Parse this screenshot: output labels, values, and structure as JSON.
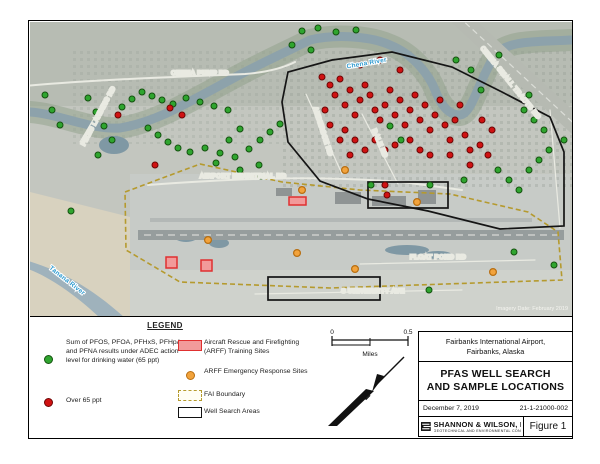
{
  "figure": {
    "legend": {
      "title": "LEGEND",
      "items": [
        {
          "symbol": "green-dot",
          "label": "Sum of PFOS, PFOA, PFHxS, PFHpA, and PFNA results under ADEC action level for drinking water (65 ppt)"
        },
        {
          "symbol": "red-dot",
          "label": "Over 65 ppt"
        },
        {
          "symbol": "arff-training-swatch",
          "label": "Aircraft Rescue and Firefighting (ARFF) Training Sites"
        },
        {
          "symbol": "orange-dot",
          "label": "ARFF Emergency Response Sites"
        },
        {
          "symbol": "fai-boundary-swatch",
          "label": "FAI Boundary"
        },
        {
          "symbol": "well-search-swatch",
          "label": "Well Search Areas"
        }
      ]
    },
    "scale_bar": {
      "left": "0",
      "right": "0.5",
      "units": "Miles"
    },
    "north_arrow": "N",
    "title_block": {
      "location_line1": "Fairbanks International Airport,",
      "location_line2": "Fairbanks, Alaska",
      "title_line1": "PFAS WELL SEARCH",
      "title_line2": "AND SAMPLE LOCATIONS",
      "date": "December 7, 2019",
      "project_number": "21-1-21000-002",
      "company": "SHANNON & WILSON, INC.",
      "company_tagline": "GEOTECHNICAL AND ENVIRONMENTAL CONSULTANTS",
      "figure_label": "Figure 1"
    },
    "map": {
      "credit": "Imagery Date: February 2019",
      "colors": {
        "under_green": "#2fa52f",
        "over_red": "#d01212",
        "arff_orange": "#f2a33c",
        "training_fill": "#f29a9a",
        "training_stroke": "#e03030",
        "fai_boundary": "#b59a2e",
        "water_label": "#2f9bd0"
      },
      "labels": [
        {
          "text": "CHENA PUMP RD",
          "x": 170,
          "y": 53,
          "rot": 0,
          "kind": "road"
        },
        {
          "text": "Chena River",
          "x": 337,
          "y": 43,
          "rot": -10,
          "kind": "water"
        },
        {
          "text": "CHENA SMALL TRACTS RD",
          "x": 479,
          "y": 62,
          "rot": 51,
          "kind": "road"
        },
        {
          "text": "PIKES LANDING RD",
          "x": 70,
          "y": 95,
          "rot": -62,
          "kind": "road"
        },
        {
          "text": "AIRPORT INDUSTRIAL RD",
          "x": 213,
          "y": 156,
          "rot": 0,
          "kind": "road"
        },
        {
          "text": "ANDERSON RD",
          "x": 291,
          "y": 110,
          "rot": 72,
          "kind": "road"
        },
        {
          "text": "DALE RD",
          "x": 348,
          "y": 122,
          "rot": 67,
          "kind": "road"
        },
        {
          "text": "FLOAT POND RD",
          "x": 408,
          "y": 237,
          "rot": 0,
          "kind": "road"
        },
        {
          "text": "S UNIVERSITY AVE",
          "x": 343,
          "y": 271,
          "rot": 0,
          "kind": "road"
        },
        {
          "text": "Tanana River",
          "x": 36,
          "y": 260,
          "rot": 38,
          "kind": "water"
        },
        {
          "text": "Imagery Date: February 2019",
          "x": 538,
          "y": 288,
          "rot": 0,
          "kind": "credit"
        }
      ],
      "markers": {
        "green": [
          [
            15,
            73
          ],
          [
            22,
            88
          ],
          [
            30,
            103
          ],
          [
            58,
            76
          ],
          [
            66,
            90
          ],
          [
            74,
            104
          ],
          [
            82,
            118
          ],
          [
            68,
            133
          ],
          [
            92,
            85
          ],
          [
            102,
            77
          ],
          [
            112,
            70
          ],
          [
            122,
            74
          ],
          [
            132,
            78
          ],
          [
            143,
            82
          ],
          [
            156,
            76
          ],
          [
            170,
            80
          ],
          [
            184,
            84
          ],
          [
            198,
            88
          ],
          [
            118,
            106
          ],
          [
            128,
            113
          ],
          [
            138,
            120
          ],
          [
            148,
            126
          ],
          [
            160,
            130
          ],
          [
            175,
            126
          ],
          [
            190,
            131
          ],
          [
            205,
            135
          ],
          [
            219,
            127
          ],
          [
            230,
            118
          ],
          [
            240,
            110
          ],
          [
            250,
            102
          ],
          [
            210,
            107
          ],
          [
            199,
            118
          ],
          [
            186,
            141
          ],
          [
            210,
            148
          ],
          [
            229,
            143
          ],
          [
            262,
            23
          ],
          [
            272,
            9
          ],
          [
            288,
            6
          ],
          [
            306,
            10
          ],
          [
            326,
            8
          ],
          [
            281,
            28
          ],
          [
            360,
            104
          ],
          [
            371,
            118
          ],
          [
            341,
            163
          ],
          [
            400,
            163
          ],
          [
            434,
            158
          ],
          [
            468,
            148
          ],
          [
            479,
            158
          ],
          [
            489,
            168
          ],
          [
            499,
            148
          ],
          [
            509,
            138
          ],
          [
            519,
            128
          ],
          [
            514,
            108
          ],
          [
            504,
            98
          ],
          [
            494,
            88
          ],
          [
            451,
            68
          ],
          [
            441,
            48
          ],
          [
            426,
            38
          ],
          [
            469,
            33
          ],
          [
            499,
            73
          ],
          [
            484,
            230
          ],
          [
            399,
            268
          ],
          [
            231,
            154
          ],
          [
            41,
            189
          ],
          [
            524,
            243
          ],
          [
            534,
            118
          ]
        ],
        "red": [
          [
            292,
            55
          ],
          [
            300,
            63
          ],
          [
            310,
            57
          ],
          [
            305,
            73
          ],
          [
            315,
            83
          ],
          [
            295,
            88
          ],
          [
            320,
            68
          ],
          [
            325,
            93
          ],
          [
            330,
            78
          ],
          [
            335,
            63
          ],
          [
            340,
            73
          ],
          [
            345,
            88
          ],
          [
            350,
            98
          ],
          [
            355,
            83
          ],
          [
            360,
            68
          ],
          [
            365,
            93
          ],
          [
            370,
            78
          ],
          [
            375,
            103
          ],
          [
            380,
            88
          ],
          [
            385,
            73
          ],
          [
            390,
            98
          ],
          [
            395,
            83
          ],
          [
            400,
            108
          ],
          [
            405,
            93
          ],
          [
            410,
            78
          ],
          [
            415,
            103
          ],
          [
            420,
            118
          ],
          [
            425,
            98
          ],
          [
            430,
            83
          ],
          [
            435,
            113
          ],
          [
            440,
            128
          ],
          [
            315,
            108
          ],
          [
            325,
            118
          ],
          [
            335,
            128
          ],
          [
            345,
            118
          ],
          [
            355,
            128
          ],
          [
            365,
            123
          ],
          [
            300,
            103
          ],
          [
            310,
            118
          ],
          [
            320,
            133
          ],
          [
            380,
            118
          ],
          [
            390,
            128
          ],
          [
            400,
            133
          ],
          [
            420,
            133
          ],
          [
            440,
            143
          ],
          [
            450,
            123
          ],
          [
            458,
            133
          ],
          [
            330,
            43
          ],
          [
            350,
            38
          ],
          [
            370,
            48
          ],
          [
            88,
            93
          ],
          [
            125,
            143
          ],
          [
            140,
            86
          ],
          [
            152,
            93
          ],
          [
            355,
            163
          ],
          [
            357,
            173
          ],
          [
            452,
            98
          ],
          [
            462,
            108
          ]
        ],
        "orange": [
          [
            178,
            218
          ],
          [
            267,
            231
          ],
          [
            325,
            247
          ],
          [
            315,
            148
          ],
          [
            272,
            168
          ],
          [
            387,
            180
          ],
          [
            463,
            250
          ]
        ],
        "arff_training": [
          [
            259,
            175,
            17,
            8
          ],
          [
            136,
            235,
            11,
            11
          ],
          [
            171,
            238,
            11,
            11
          ]
        ]
      }
    }
  }
}
